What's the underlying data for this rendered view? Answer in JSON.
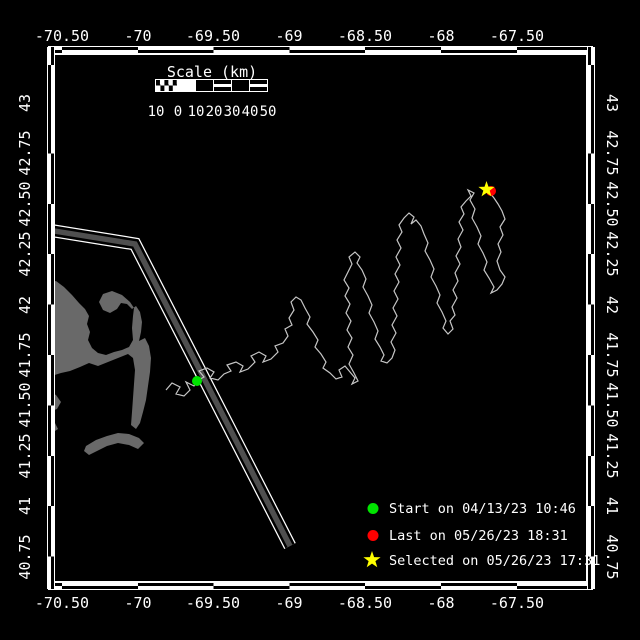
{
  "axes": {
    "lon_ticks": [
      "-70.50",
      "-70",
      "-69.50",
      "-69",
      "-68.50",
      "-68",
      "-67.50"
    ],
    "lat_ticks": [
      "43",
      "42.75",
      "42.50",
      "42.25",
      "42",
      "41.75",
      "41.50",
      "41.25",
      "41",
      "40.75"
    ]
  },
  "scalebar": {
    "title": "Scale (km)",
    "tick_labels": [
      "10",
      "0",
      "10",
      "20",
      "30",
      "40",
      "50"
    ]
  },
  "legend": {
    "start": {
      "marker": "circle",
      "color": "#00e400",
      "label": "Start on 04/13/23 10:46"
    },
    "last": {
      "marker": "circle",
      "color": "#ff0000",
      "label": "Last on 05/26/23 18:31"
    },
    "selected": {
      "marker": "star",
      "color": "#ffff00",
      "label": "Selected on 05/26/23 17:31"
    }
  },
  "colors": {
    "background": "#000000",
    "frame": "#ffffff",
    "land": "#696969",
    "track": "#c6c6c6",
    "lane_core": "#4f4f4f",
    "text": "#ffffff"
  }
}
